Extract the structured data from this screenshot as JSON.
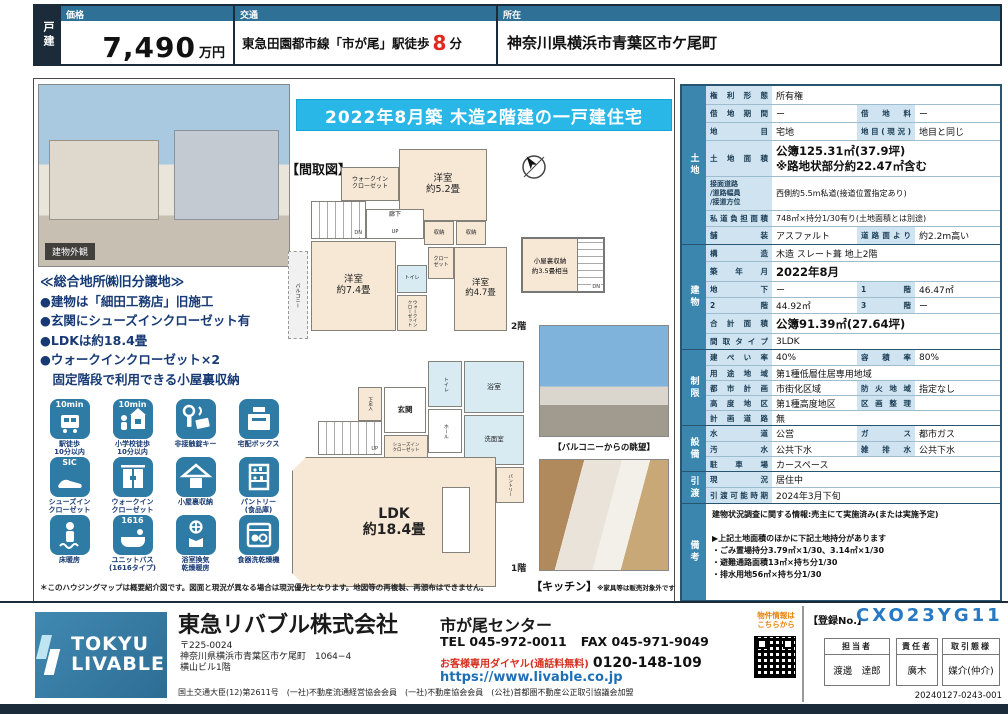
{
  "header": {
    "property_type": "戸建",
    "price_label": "価格",
    "price_value": "7,490",
    "price_unit": "万円",
    "access_label": "交通",
    "access_pre": "東急田園都市線「市が尾」駅徒歩",
    "access_minutes": "8",
    "access_post": "分",
    "location_label": "所在",
    "location_value": "神奈川県横浜市青葉区市ケ尾町"
  },
  "banner": "2022年8月築 木造2階建の一戸建住宅",
  "photos": {
    "exterior_label": "建物外観",
    "balcony_caption": "【バルコニーからの眺望】",
    "kitchen_caption": "【キッチン】",
    "kitchen_note": "※家具等は販売対象外です"
  },
  "highlights": {
    "title": "≪総合地所㈱旧分譲地≫",
    "items": [
      "●建物は「細田工務店」旧施工",
      "●玄関にシューズインクローゼット有",
      "●LDKは約18.4畳",
      "●ウォークインクローゼット×2",
      "　固定階段で利用できる小屋裏収納"
    ]
  },
  "features": [
    {
      "label": "駅徒歩\n10分以内",
      "badge": "10min"
    },
    {
      "label": "小学校徒歩\n10分以内",
      "badge": "10min"
    },
    {
      "label": "非接触錠キー"
    },
    {
      "label": "宅配ボックス"
    },
    {
      "label": "シューズイン\nクローゼット",
      "badge": "SIC"
    },
    {
      "label": "ウォークイン\nクローゼット"
    },
    {
      "label": "小屋裏収納"
    },
    {
      "label": "パントリー\n(食品庫)"
    },
    {
      "label": "床暖房"
    },
    {
      "label": "ユニットバス\n(1616タイプ)",
      "badge": "1616"
    },
    {
      "label": "浴室換気\n乾燥暖房"
    },
    {
      "label": "食器洗乾燥機"
    }
  ],
  "floorplan": {
    "title": "【間取図】",
    "floor2_label": "2階",
    "floor1_label": "1階",
    "attic": "小屋裏収納\n約3.5畳相当",
    "f2": {
      "bed52": "洋室\n約5.2畳",
      "bed74": "洋室\n約7.4畳",
      "bed47": "洋室\n約4.7畳",
      "wic1": "ウォークイン\nクローゼット",
      "wic2": "ウォークイン\nクローゼット",
      "closet": "クロー\nゼット",
      "storage1": "収納",
      "storage2": "収納",
      "hallway": "廊下",
      "toilet": "トイレ",
      "balcony": "バルコニー",
      "dn": "DN",
      "up": "UP"
    },
    "f1": {
      "ldk": "LDK\n約18.4畳",
      "genkan": "玄関",
      "hall": "ホール",
      "toilet": "トイレ",
      "bath": "浴室",
      "washroom": "洗面室",
      "shoebox": "下足入",
      "sic": "シューズイン\nクローゼット",
      "pantry": "パントリー",
      "up": "UP",
      "dn": "DN"
    }
  },
  "map_note": "＊このハウジングマップは概要紹介図です。図面と現況が異なる場合は現況優先となります。地図等の再複製、再頒布はできません。",
  "spec": {
    "sections": {
      "land": "土地",
      "building": "建物",
      "restriction": "制限",
      "equipment": "設備",
      "handover": "引渡",
      "notes": "備考"
    },
    "land": {
      "r1": {
        "l": "権利形態",
        "v": "所有権"
      },
      "r2": {
        "l": "借地期間",
        "v": "ー",
        "l2": "借地料",
        "v2": "ー"
      },
      "r3": {
        "l": "地目",
        "v": "宅地",
        "l2": "地目(現況)",
        "v2": "地目と同じ"
      },
      "r4": {
        "l": "土地面積",
        "v": "公簿125.31㎡(37.9坪)\n※路地状部分約22.47㎡含む"
      },
      "r5": {
        "l": "接面道路\n/道路幅員\n/接道方位",
        "v": "西側約5.5m私道(接道位置指定あり)"
      },
      "r6": {
        "l": "私道負担面積",
        "v": "748㎡×持分1/30有り(土地面積とは別途)"
      },
      "r7": {
        "l": "舗装",
        "v": "アスファルト",
        "l2": "道路面より",
        "v2": "約2.2m高い"
      }
    },
    "building": {
      "r1": {
        "l": "構造",
        "v": "木造 スレート葺 地上2階"
      },
      "r2": {
        "l": "築年月",
        "v": "2022年8月"
      },
      "r3": {
        "l": "地下",
        "v": "ー",
        "l2": "1階",
        "v2": "46.47㎡"
      },
      "r4": {
        "l": "2階",
        "v": "44.92㎡",
        "l2": "3階",
        "v2": "ー"
      },
      "r5": {
        "l": "合計面積",
        "v": "公簿91.39㎡(27.64坪)"
      },
      "r6": {
        "l": "間取タイプ",
        "v": "3LDK"
      }
    },
    "restriction": {
      "r1": {
        "l": "建ぺい率",
        "v": "40%",
        "l2": "容積率",
        "v2": "80%"
      },
      "r2": {
        "l": "用途地域",
        "v": "第1種低層住居専用地域"
      },
      "r3": {
        "l": "都市計画",
        "v": "市街化区域",
        "l2": "防火地域",
        "v2": "指定なし"
      },
      "r4": {
        "l": "高度地区",
        "v": "第1種高度地区",
        "l2": "区画整理",
        "v2": ""
      },
      "r5": {
        "l": "計画道路",
        "v": "無"
      }
    },
    "equipment": {
      "r1": {
        "l": "水道",
        "v": "公営",
        "l2": "ガス",
        "v2": "都市ガス"
      },
      "r2": {
        "l": "汚水",
        "v": "公共下水",
        "l2": "雑排水",
        "v2": "公共下水"
      },
      "r3": {
        "l": "駐車場",
        "v": "カースペース"
      }
    },
    "handover": {
      "r1": {
        "l": "現況",
        "v": "居住中"
      },
      "r2": {
        "l": "引渡可能時期",
        "v": "2024年3月下旬"
      }
    },
    "notes_text": "建物状況調査に関する情報:売主にて実施済み(または実施予定)\n\n▶上記土地面積のほかに下記土地持分があります\n・ごみ置場持分3.79㎡×1/30、3.14㎡×1/30\n・避難通路面積13㎡×持ち分1/30\n・排水用地56㎡×持ち分1/30"
  },
  "footer": {
    "logo_line1": "TOKYU",
    "logo_line2": "LIVABLE",
    "company": "東急リバブル株式会社",
    "branch": "市が尾センター",
    "postal": "〒225-0024",
    "address1": "神奈川県横浜市青葉区市ケ尾町　1064−4",
    "address2": "横山ビル1階",
    "tel": "TEL 045-972-0011",
    "fax": "FAX 045-971-9049",
    "dial_label": "お客様専用ダイヤル(通話料無料)",
    "dial_number": "0120-148-109",
    "url": "https://www.livable.co.jp",
    "license": "国土交通大臣(12)第2611号　(一社)不動産流通経営協会会員　(一社)不動産協会会員　(公社)首都圏不動産公正取引協議会加盟",
    "qr_note": "物件情報は\nこちらから",
    "reg_label": "【登録No.】",
    "reg_value": "CXO23YG11",
    "staff_label": "担当者",
    "staff_value": "渡邊　達郎",
    "manager_label": "責任者",
    "manager_value": "廣木",
    "deal_label": "取引態様",
    "deal_value": "媒介(仲介)",
    "doc_number": "20240127-0243-001"
  }
}
